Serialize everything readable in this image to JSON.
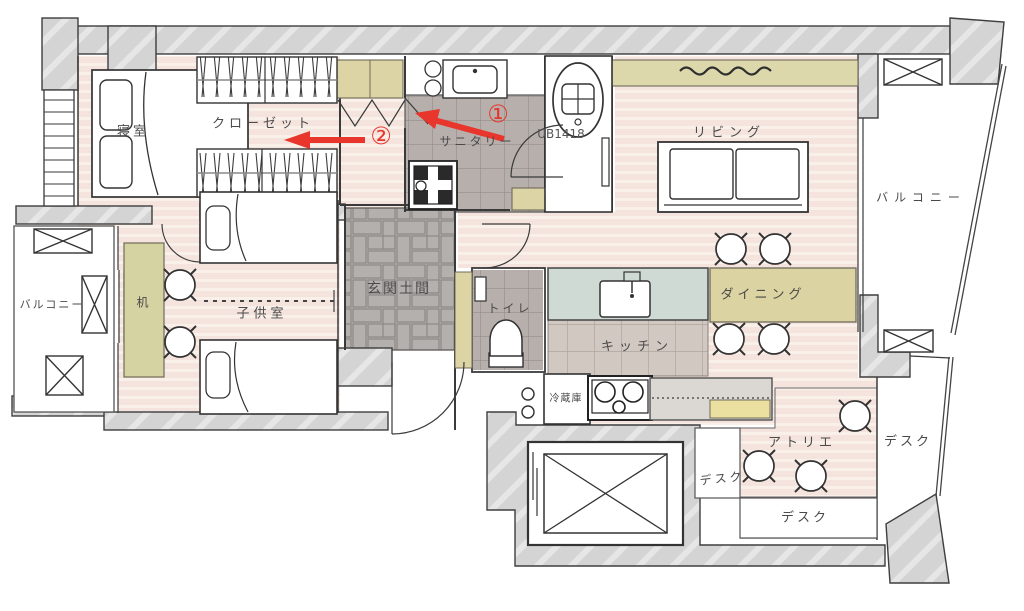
{
  "labels": {
    "bedroom": "寝室",
    "closet": "クローゼット",
    "sanitary": "サニタリー",
    "bath_unit": "UB1418",
    "living": "リビング",
    "balcony_right": "バルコニー",
    "balcony_left": "バルコニー",
    "dining": "ダイニング",
    "kitchen": "キッチン",
    "fridge": "冷蔵庫",
    "toilet": "トイレ",
    "entrance_doma": "玄関土間",
    "kids_room": "子供室",
    "desk_small": "机",
    "atelier": "アトリエ",
    "desk_left": "デスク",
    "desk_bottom": "デスク",
    "desk_right": "デスク"
  },
  "annotations": {
    "step1": "①",
    "step2": "②"
  },
  "colors": {
    "accent_red": "#e8362d",
    "wall_gray": "#d4d4d4",
    "floor_pink": "#f6e7e1",
    "tile_gray": "#b6afab",
    "brick_gray": "#b6b2af",
    "kitchen_tile": "#d1c8c2",
    "khaki": "#dcd4a4",
    "counter_blue": "#cfdad5",
    "cabinet_yellow": "#ebe09f",
    "line_dark": "#3a3a3a"
  }
}
